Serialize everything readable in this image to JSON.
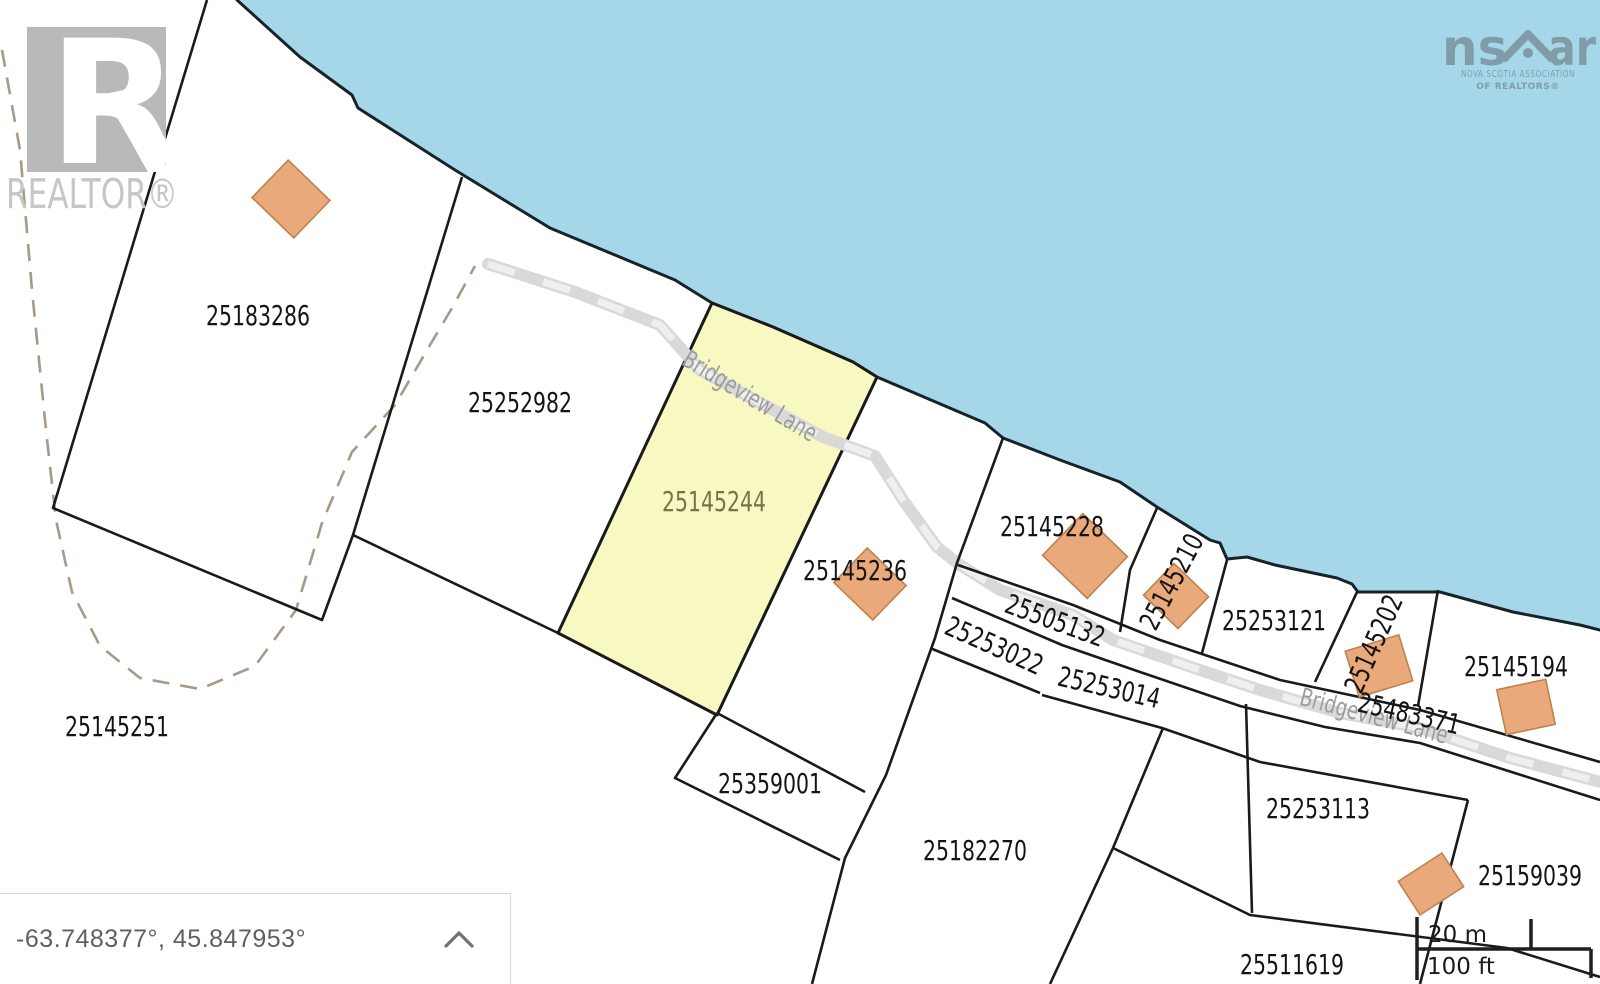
{
  "map": {
    "road_name": "Bridgeview Lane",
    "highlighted_parcel": "25145244",
    "colors": {
      "water": "#a5d7e9",
      "shoreline": "#16232b",
      "boundary": "#1a1a1a",
      "parcel_fill": "#ffffff",
      "highlight_fill": "#f8f8c2",
      "highlight_label": "#74744b",
      "building_fill": "#e9a97a",
      "building_stroke": "#bc824f",
      "road_fill": "#d9d9d9",
      "road_dash": "#efefef",
      "road_label": "#9c9c9c",
      "dashed_line": "#a79a85",
      "label": "#141414"
    },
    "parcel_labels": [
      {
        "id": "25183286",
        "x": 258,
        "y": 316,
        "rot": 0
      },
      {
        "id": "25252982",
        "x": 520,
        "y": 403,
        "rot": 0
      },
      {
        "id": "25145244",
        "x": 714,
        "y": 502,
        "rot": 0,
        "color": "#74744b"
      },
      {
        "id": "25145236",
        "x": 855,
        "y": 571,
        "rot": 0
      },
      {
        "id": "25145228",
        "x": 1052,
        "y": 527,
        "rot": 0
      },
      {
        "id": "25145210",
        "x": 1172,
        "y": 582,
        "rot": -62
      },
      {
        "id": "25505132",
        "x": 1055,
        "y": 621,
        "rot": 20
      },
      {
        "id": "25253022",
        "x": 994,
        "y": 646,
        "rot": 24
      },
      {
        "id": "25253014",
        "x": 1109,
        "y": 688,
        "rot": 13
      },
      {
        "id": "25253121",
        "x": 1274,
        "y": 621,
        "rot": 0
      },
      {
        "id": "25145202",
        "x": 1374,
        "y": 644,
        "rot": -66
      },
      {
        "id": "25145194",
        "x": 1516,
        "y": 667,
        "rot": 0
      },
      {
        "id": "25483371",
        "x": 1409,
        "y": 714,
        "rot": 13
      },
      {
        "id": "25359001",
        "x": 770,
        "y": 784,
        "rot": 0
      },
      {
        "id": "25182270",
        "x": 975,
        "y": 851,
        "rot": 0
      },
      {
        "id": "25253113",
        "x": 1318,
        "y": 809,
        "rot": 0
      },
      {
        "id": "25159039",
        "x": 1530,
        "y": 876,
        "rot": 0
      },
      {
        "id": "25511619",
        "x": 1292,
        "y": 965,
        "rot": 0
      },
      {
        "id": "25145251",
        "x": 117,
        "y": 727,
        "rot": 0
      }
    ],
    "road_labels": [
      {
        "text": "Bridgeview Lane",
        "x": 750,
        "y": 396,
        "rot": 31
      },
      {
        "text": "Bridgeview Lane",
        "x": 1374,
        "y": 716,
        "rot": 15
      }
    ],
    "buildings": [
      {
        "x": 291,
        "y": 199,
        "w": 58,
        "h": 52,
        "rot": 44
      },
      {
        "x": 870,
        "y": 584,
        "w": 54,
        "h": 48,
        "rot": 44
      },
      {
        "x": 1085,
        "y": 556,
        "w": 62,
        "h": 58,
        "rot": 44
      },
      {
        "x": 1176,
        "y": 596,
        "w": 48,
        "h": 44,
        "rot": 44
      },
      {
        "x": 1379,
        "y": 666,
        "w": 56,
        "h": 48,
        "rot": -17
      },
      {
        "x": 1526,
        "y": 707,
        "w": 50,
        "h": 46,
        "rot": -12
      },
      {
        "x": 1431,
        "y": 884,
        "w": 52,
        "h": 40,
        "rot": -33
      }
    ]
  },
  "watermarks": {
    "realtor": {
      "letter": "R",
      "label": "REALTOR®"
    },
    "nsar": {
      "left": "ns",
      "right": "ar",
      "line1": "NOVA SCOTIA ASSOCIATION",
      "line2": "OF REALTORS®"
    }
  },
  "status_bar": {
    "coordinates": "-63.748377°, 45.847953°"
  },
  "scale_bar": {
    "metric": "20 m",
    "imperial": "100 ft"
  }
}
